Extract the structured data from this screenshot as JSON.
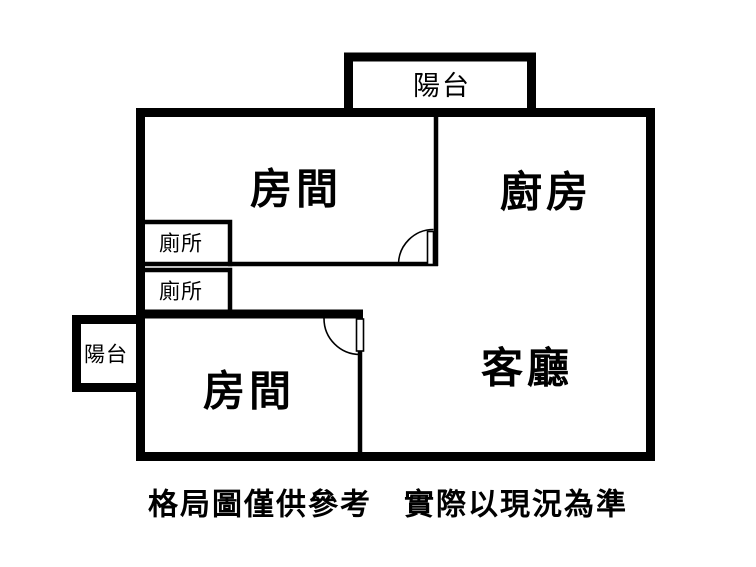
{
  "floor_plan": {
    "labels": {
      "balcony_top": "陽台",
      "balcony_left": "陽台",
      "bedroom_top": "房間",
      "kitchen": "廚房",
      "toilet_upper": "廁所",
      "toilet_lower": "廁所",
      "bedroom_bottom": "房間",
      "living_room": "客廳"
    },
    "caption": "格局圖僅供參考　實際以現況為準",
    "colors": {
      "walls": "#000000",
      "text": "#000000",
      "background": "#ffffff"
    }
  }
}
